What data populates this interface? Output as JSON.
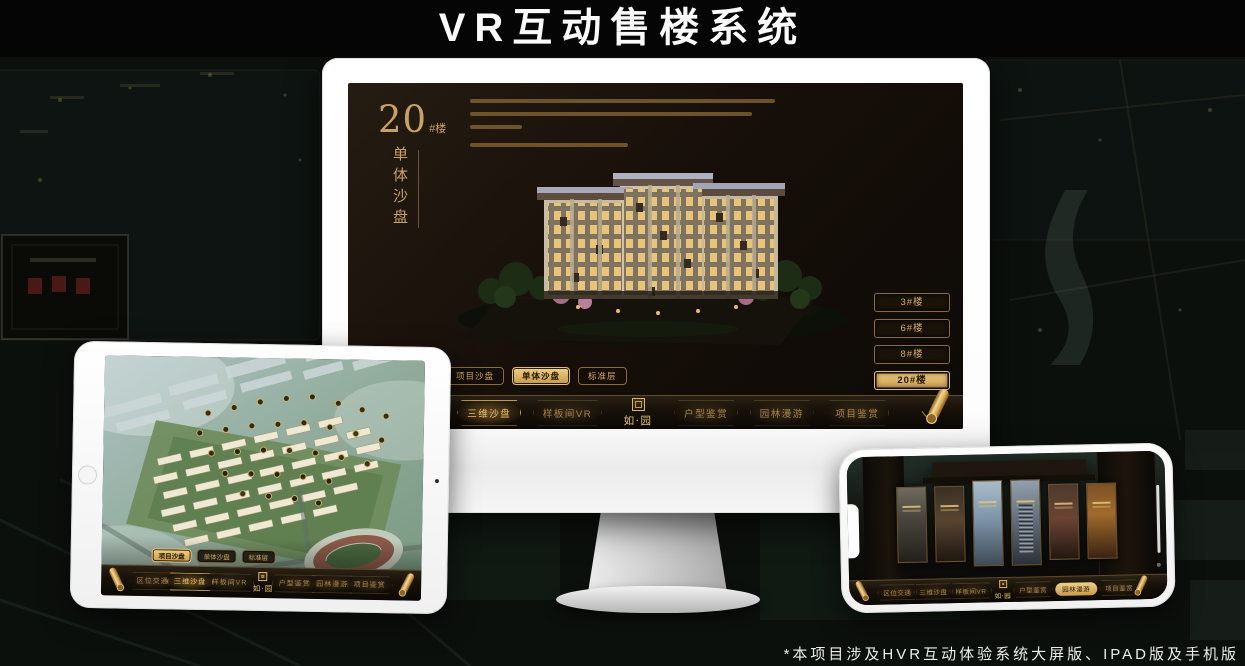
{
  "page": {
    "title": "VR互动售楼系统",
    "footnote": "*本项目涉及HVR互动体验系统大屏版、IPAD版及手机版"
  },
  "logo": {
    "name": "如·园"
  },
  "monitor": {
    "heading": {
      "number": "20",
      "suffix": "#楼",
      "vertical": "单体沙盘"
    },
    "floor_buttons": [
      {
        "label": "3#楼",
        "active": false
      },
      {
        "label": "6#楼",
        "active": false
      },
      {
        "label": "8#楼",
        "active": false
      },
      {
        "label": "20#楼",
        "active": true
      }
    ],
    "sub_tabs": [
      {
        "label": "项目沙盘",
        "active": false
      },
      {
        "label": "单体沙盘",
        "active": true
      },
      {
        "label": "标准层",
        "active": false
      }
    ],
    "nav_left": [
      {
        "label": "区位交通",
        "active": false
      },
      {
        "label": "三维沙盘",
        "active": true
      },
      {
        "label": "样板间VR",
        "active": false
      }
    ],
    "nav_right": [
      {
        "label": "户型鉴赏",
        "active": false
      },
      {
        "label": "园林漫游",
        "active": false
      },
      {
        "label": "项目鉴赏",
        "active": false
      }
    ]
  },
  "tablet": {
    "sub_tabs": [
      {
        "label": "项目沙盘",
        "active": true
      },
      {
        "label": "单体沙盘",
        "active": false
      },
      {
        "label": "标准层",
        "active": false
      }
    ],
    "nav_left": [
      {
        "label": "区位交通",
        "active": false
      },
      {
        "label": "三维沙盘",
        "active": true
      },
      {
        "label": "样板间VR",
        "active": false
      }
    ],
    "nav_right": [
      {
        "label": "户型鉴赏",
        "active": false
      },
      {
        "label": "园林漫游",
        "active": false
      },
      {
        "label": "项目鉴赏",
        "active": false
      }
    ]
  },
  "phone": {
    "nav_left": [
      {
        "label": "区位交通",
        "active": false
      },
      {
        "label": "三维沙盘",
        "active": false
      },
      {
        "label": "样板间VR",
        "active": false
      }
    ],
    "nav_right": [
      {
        "label": "户型鉴赏",
        "active": false
      },
      {
        "label": "园林漫游",
        "active": true
      },
      {
        "label": "项目鉴赏",
        "active": false
      }
    ]
  },
  "colors": {
    "gold": "#C9A263",
    "gold_bright": "#ECC36F",
    "screen_bg": "#17110A"
  }
}
